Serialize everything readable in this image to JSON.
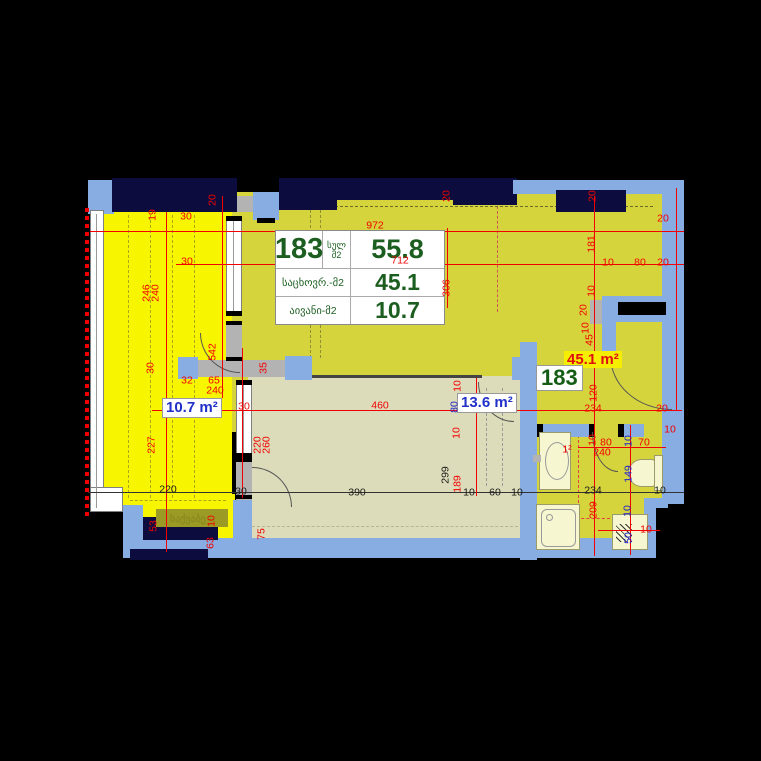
{
  "unit_table": {
    "unit_number": "183",
    "total_label": "სულ",
    "total_unit": "მ2",
    "total_value": "55.8",
    "living_label": "საცხოვრ.-მ2",
    "living_value": "45.1",
    "balcony_label": "აივანი-მ2",
    "balcony_value": "10.7"
  },
  "area_labels": {
    "balcony": "10.7 m²",
    "bedroom": "13.6 m²",
    "living": "45.1 m²",
    "unit_badge": "183"
  },
  "room_names": {
    "boiler": "საქვაბე"
  },
  "colors": {
    "dim_red": "#f20000",
    "dim_blue": "#2222cc",
    "dim_black": "#1a1a1a",
    "table_text": "#1b5e20",
    "wall_navy": "#0c0c3e",
    "wall_blue": "#88ade2",
    "balcony_yellow": "#f7f500",
    "floor_olive": "#d5d43c",
    "floor_beige": "#dcdcba",
    "fixture_cream": "#f6f6d0",
    "label_blue": "#2030c8",
    "highlight_yellow": "#f6ee00",
    "label_red": "#e01010"
  },
  "dimensions": [
    {
      "t": "972",
      "x": 375,
      "y": 226,
      "o": "h",
      "c": "red"
    },
    {
      "t": "712",
      "x": 400,
      "y": 261,
      "o": "h",
      "c": "red"
    },
    {
      "t": "20",
      "x": 663,
      "y": 219,
      "o": "h",
      "c": "red"
    },
    {
      "t": "10",
      "x": 608,
      "y": 263,
      "o": "h",
      "c": "red"
    },
    {
      "t": "80",
      "x": 640,
      "y": 263,
      "o": "h",
      "c": "red"
    },
    {
      "t": "20",
      "x": 663,
      "y": 263,
      "o": "h",
      "c": "red"
    },
    {
      "t": "30",
      "x": 186,
      "y": 217,
      "o": "h",
      "c": "red"
    },
    {
      "t": "30",
      "x": 187,
      "y": 262,
      "o": "h",
      "c": "red"
    },
    {
      "t": "32",
      "x": 187,
      "y": 381,
      "o": "h",
      "c": "red"
    },
    {
      "t": "65",
      "x": 214,
      "y": 381,
      "o": "h",
      "c": "red"
    },
    {
      "t": "240",
      "x": 215,
      "y": 391,
      "o": "h",
      "c": "red"
    },
    {
      "t": "30",
      "x": 244,
      "y": 407,
      "o": "h",
      "c": "red"
    },
    {
      "t": "460",
      "x": 380,
      "y": 406,
      "o": "h",
      "c": "red"
    },
    {
      "t": "234",
      "x": 593,
      "y": 409,
      "o": "h",
      "c": "red"
    },
    {
      "t": "20",
      "x": 662,
      "y": 409,
      "o": "h",
      "c": "red"
    },
    {
      "t": "80",
      "x": 606,
      "y": 443,
      "o": "h",
      "c": "red"
    },
    {
      "t": "240",
      "x": 602,
      "y": 453,
      "o": "h",
      "c": "red"
    },
    {
      "t": "70",
      "x": 644,
      "y": 443,
      "o": "h",
      "c": "red"
    },
    {
      "t": "10",
      "x": 670,
      "y": 430,
      "o": "h",
      "c": "red"
    },
    {
      "t": "10",
      "x": 646,
      "y": 530,
      "o": "h",
      "c": "red"
    },
    {
      "t": "1²",
      "x": 567,
      "y": 450,
      "o": "h",
      "c": "red"
    },
    {
      "t": "234",
      "x": 593,
      "y": 491,
      "o": "h",
      "c": "black"
    },
    {
      "t": "10",
      "x": 660,
      "y": 491,
      "o": "h",
      "c": "black"
    },
    {
      "t": "220",
      "x": 168,
      "y": 490,
      "o": "h",
      "c": "black"
    },
    {
      "t": "30",
      "x": 241,
      "y": 492,
      "o": "h",
      "c": "black"
    },
    {
      "t": "390",
      "x": 357,
      "y": 493,
      "o": "h",
      "c": "black"
    },
    {
      "t": "10",
      "x": 469,
      "y": 493,
      "o": "h",
      "c": "black"
    },
    {
      "t": "60",
      "x": 495,
      "y": 493,
      "o": "h",
      "c": "black"
    },
    {
      "t": "10",
      "x": 517,
      "y": 493,
      "o": "h",
      "c": "black"
    },
    {
      "t": "20",
      "x": 213,
      "y": 200,
      "o": "v",
      "c": "red"
    },
    {
      "t": "19",
      "x": 153,
      "y": 215,
      "o": "v",
      "c": "red"
    },
    {
      "t": "20",
      "x": 447,
      "y": 196,
      "o": "v",
      "c": "red"
    },
    {
      "t": "20",
      "x": 593,
      "y": 196,
      "o": "v",
      "c": "red"
    },
    {
      "t": "181",
      "x": 592,
      "y": 244,
      "o": "v",
      "c": "red"
    },
    {
      "t": "306",
      "x": 447,
      "y": 288,
      "o": "v",
      "c": "red"
    },
    {
      "t": "10",
      "x": 592,
      "y": 291,
      "o": "v",
      "c": "red"
    },
    {
      "t": "20",
      "x": 584,
      "y": 310,
      "o": "v",
      "c": "red"
    },
    {
      "t": "10",
      "x": 586,
      "y": 328,
      "o": "v",
      "c": "red"
    },
    {
      "t": "45",
      "x": 590,
      "y": 340,
      "o": "v",
      "c": "red"
    },
    {
      "t": "120",
      "x": 594,
      "y": 393,
      "o": "v",
      "c": "red"
    },
    {
      "t": "246",
      "x": 147,
      "y": 293,
      "o": "v",
      "c": "red"
    },
    {
      "t": "240",
      "x": 156,
      "y": 293,
      "o": "v",
      "c": "red"
    },
    {
      "t": "30",
      "x": 151,
      "y": 368,
      "o": "v",
      "c": "red"
    },
    {
      "t": "542",
      "x": 213,
      "y": 352,
      "o": "v",
      "c": "red"
    },
    {
      "t": "35",
      "x": 264,
      "y": 368,
      "o": "v",
      "c": "red"
    },
    {
      "t": "227",
      "x": 152,
      "y": 445,
      "o": "v",
      "c": "red"
    },
    {
      "t": "220",
      "x": 258,
      "y": 445,
      "o": "v",
      "c": "red"
    },
    {
      "t": "260",
      "x": 267,
      "y": 445,
      "o": "v",
      "c": "red"
    },
    {
      "t": "10",
      "x": 458,
      "y": 386,
      "o": "v",
      "c": "red"
    },
    {
      "t": "10",
      "x": 457,
      "y": 433,
      "o": "v",
      "c": "red"
    },
    {
      "t": "189",
      "x": 458,
      "y": 484,
      "o": "v",
      "c": "red"
    },
    {
      "t": "10",
      "x": 593,
      "y": 440,
      "o": "v",
      "c": "red"
    },
    {
      "t": "209",
      "x": 594,
      "y": 510,
      "o": "v",
      "c": "red"
    },
    {
      "t": "53",
      "x": 154,
      "y": 526,
      "o": "v",
      "c": "red"
    },
    {
      "t": "10",
      "x": 212,
      "y": 521,
      "o": "v",
      "c": "red"
    },
    {
      "t": "63",
      "x": 211,
      "y": 543,
      "o": "v",
      "c": "red"
    },
    {
      "t": "75",
      "x": 262,
      "y": 534,
      "o": "v",
      "c": "red"
    },
    {
      "t": "10",
      "x": 629,
      "y": 441,
      "o": "v",
      "c": "blue"
    },
    {
      "t": "149",
      "x": 629,
      "y": 474,
      "o": "v",
      "c": "blue"
    },
    {
      "t": "10",
      "x": 628,
      "y": 511,
      "o": "v",
      "c": "blue"
    },
    {
      "t": "50",
      "x": 629,
      "y": 538,
      "o": "v",
      "c": "blue"
    },
    {
      "t": "80",
      "x": 455,
      "y": 407,
      "o": "v",
      "c": "blue"
    },
    {
      "t": "299",
      "x": 446,
      "y": 475,
      "o": "v",
      "c": "black"
    }
  ]
}
